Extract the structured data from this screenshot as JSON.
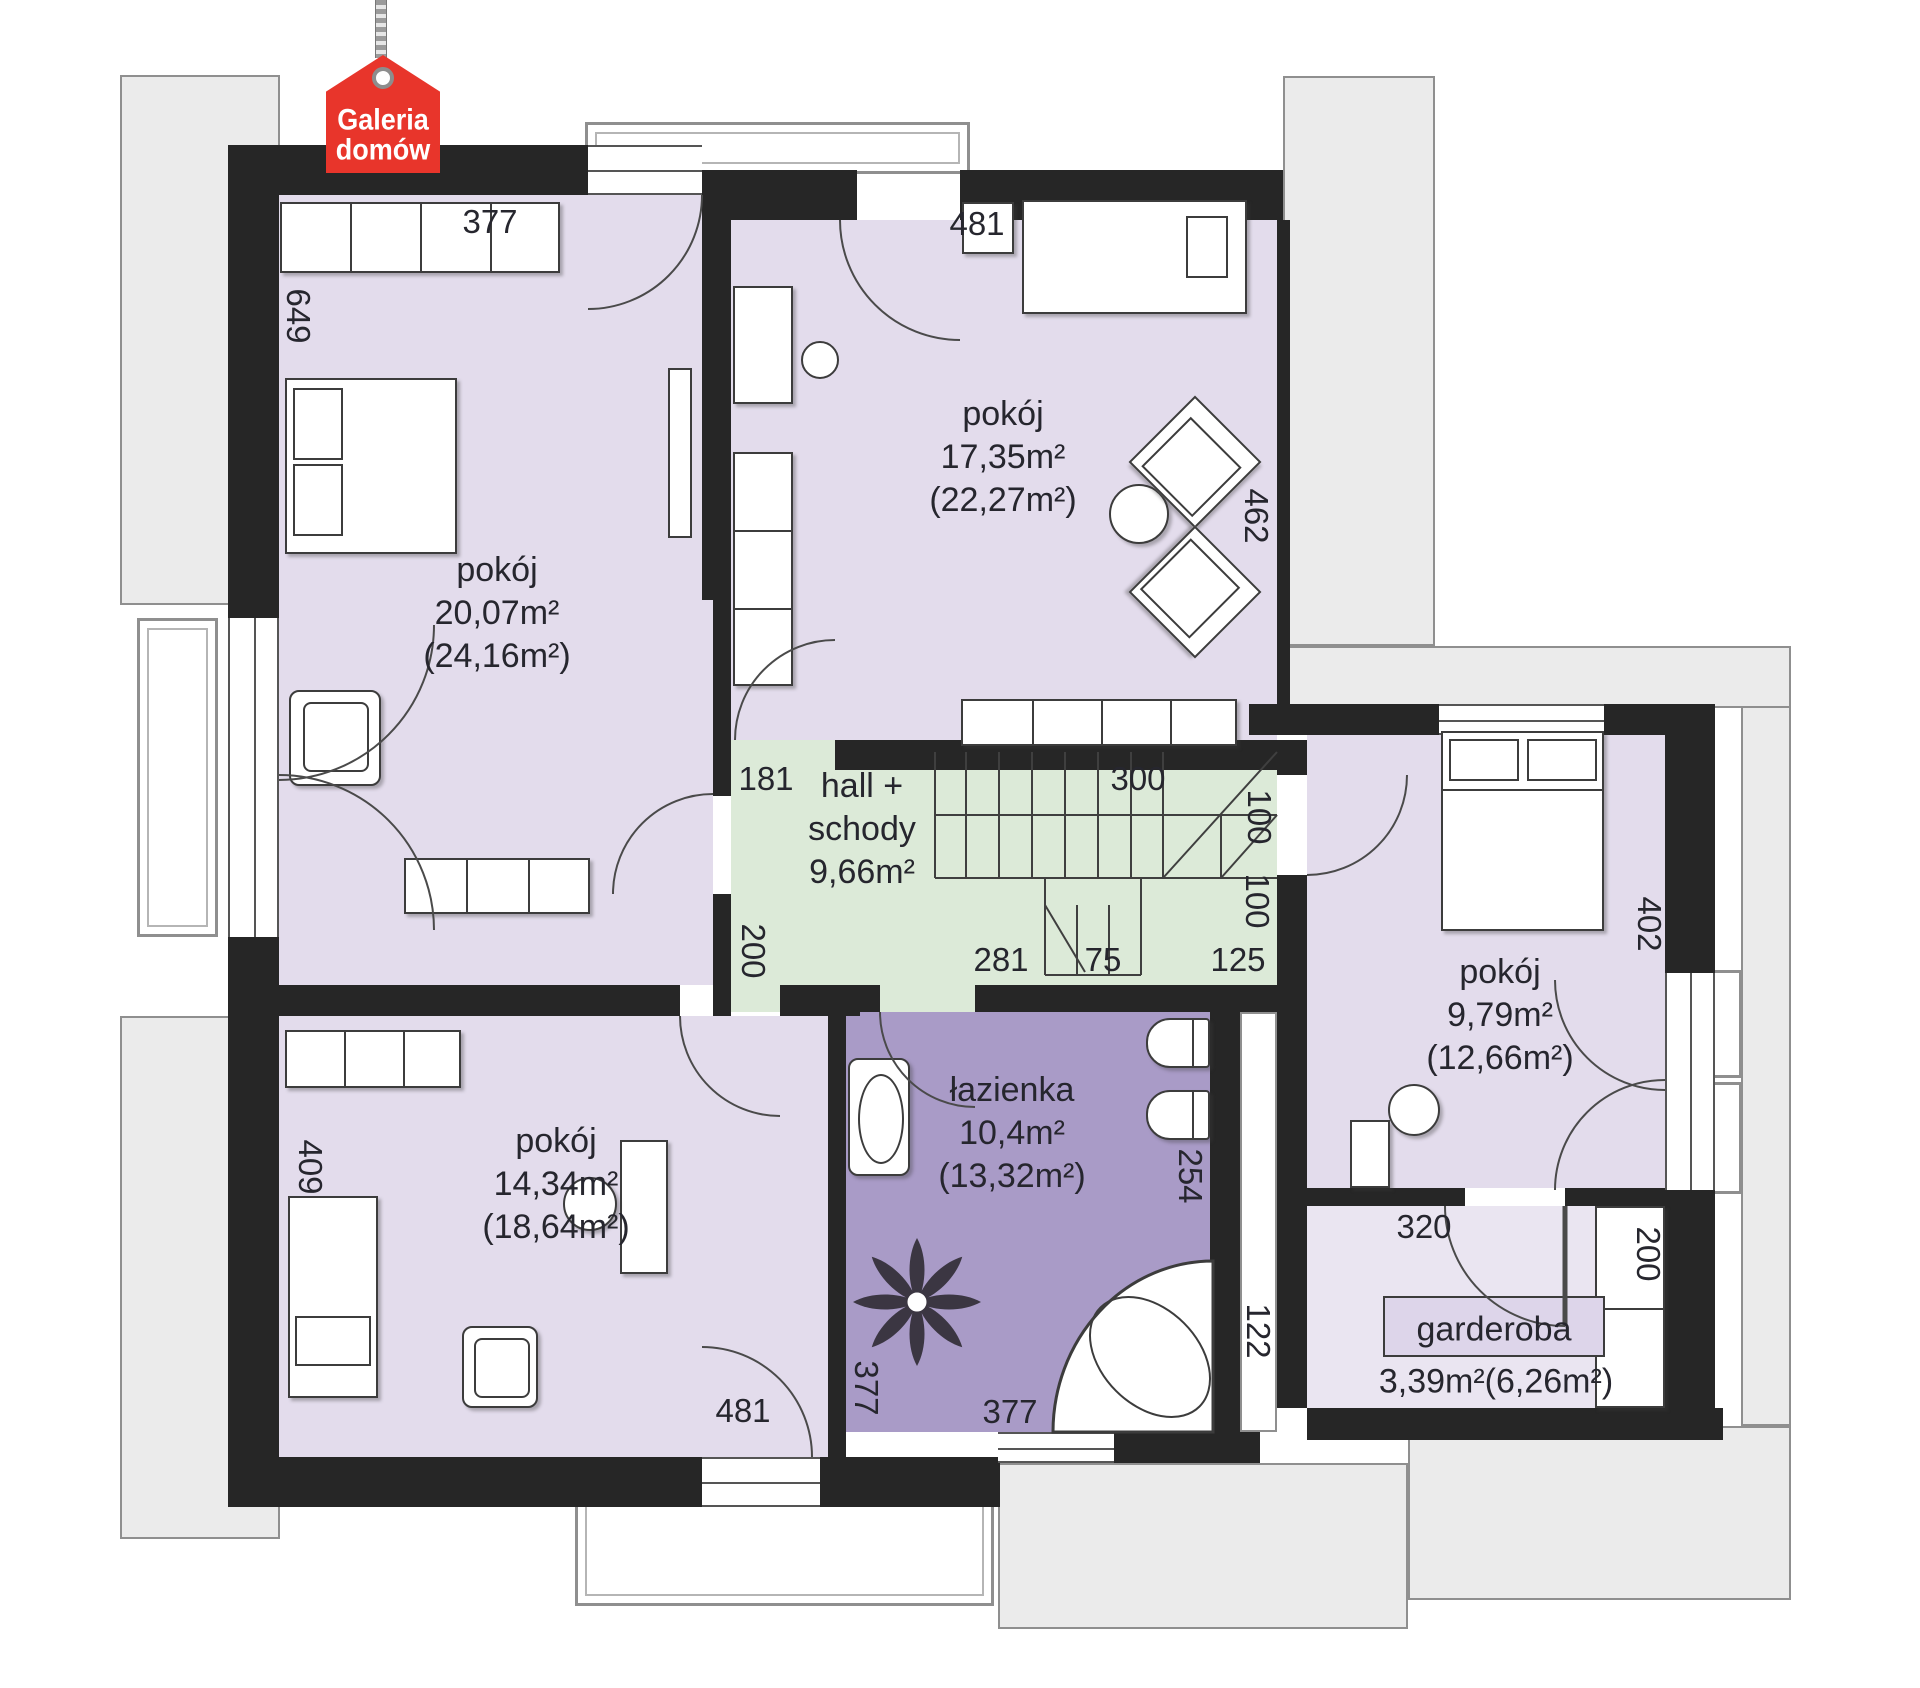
{
  "logo": {
    "line1": "Galeria",
    "line2": "domów"
  },
  "rooms": {
    "room_top_left": {
      "name": "pokój",
      "area": "20,07m²",
      "area_total": "(24,16m²)"
    },
    "room_top_middle": {
      "name": "pokój",
      "area": "17,35m²",
      "area_total": "(22,27m²)"
    },
    "hall": {
      "name_line1": "hall +",
      "name_line2": "schody",
      "area": "9,66m²"
    },
    "room_right": {
      "name": "pokój",
      "area": "9,79m²",
      "area_total": "(12,66m²)"
    },
    "room_bottom_left": {
      "name": "pokój",
      "area": "14,34m²",
      "area_total": "(18,64m²)"
    },
    "bathroom": {
      "name": "łazienka",
      "area": "10,4m²",
      "area_total": "(13,32m²)"
    },
    "garderoba": {
      "name": "garderoba",
      "area": "3,39m²(6,26m²)"
    }
  },
  "dims": {
    "top_377": "377",
    "left_649": "649",
    "top_481": "481",
    "right_462": "462",
    "hall_181": "181",
    "stairs_300": "300",
    "stairs_100_a": "100",
    "stairs_100_b": "100",
    "hall_200": "200",
    "hall_281": "281",
    "stairs_75": "75",
    "hall_125": "125",
    "right_402": "402",
    "left_409": "409",
    "bottom_481": "481",
    "bath_377_left": "377",
    "bath_377_bottom": "377",
    "bath_254": "254",
    "bath_122": "122",
    "gard_320": "320",
    "gard_200": "200"
  },
  "colors": {
    "room": "#e3dcec",
    "bathroom": "#a99bc7",
    "hall": "#dcead8",
    "wall": "#262626",
    "roof": "#ebebeb",
    "logo": "#e8352b"
  }
}
